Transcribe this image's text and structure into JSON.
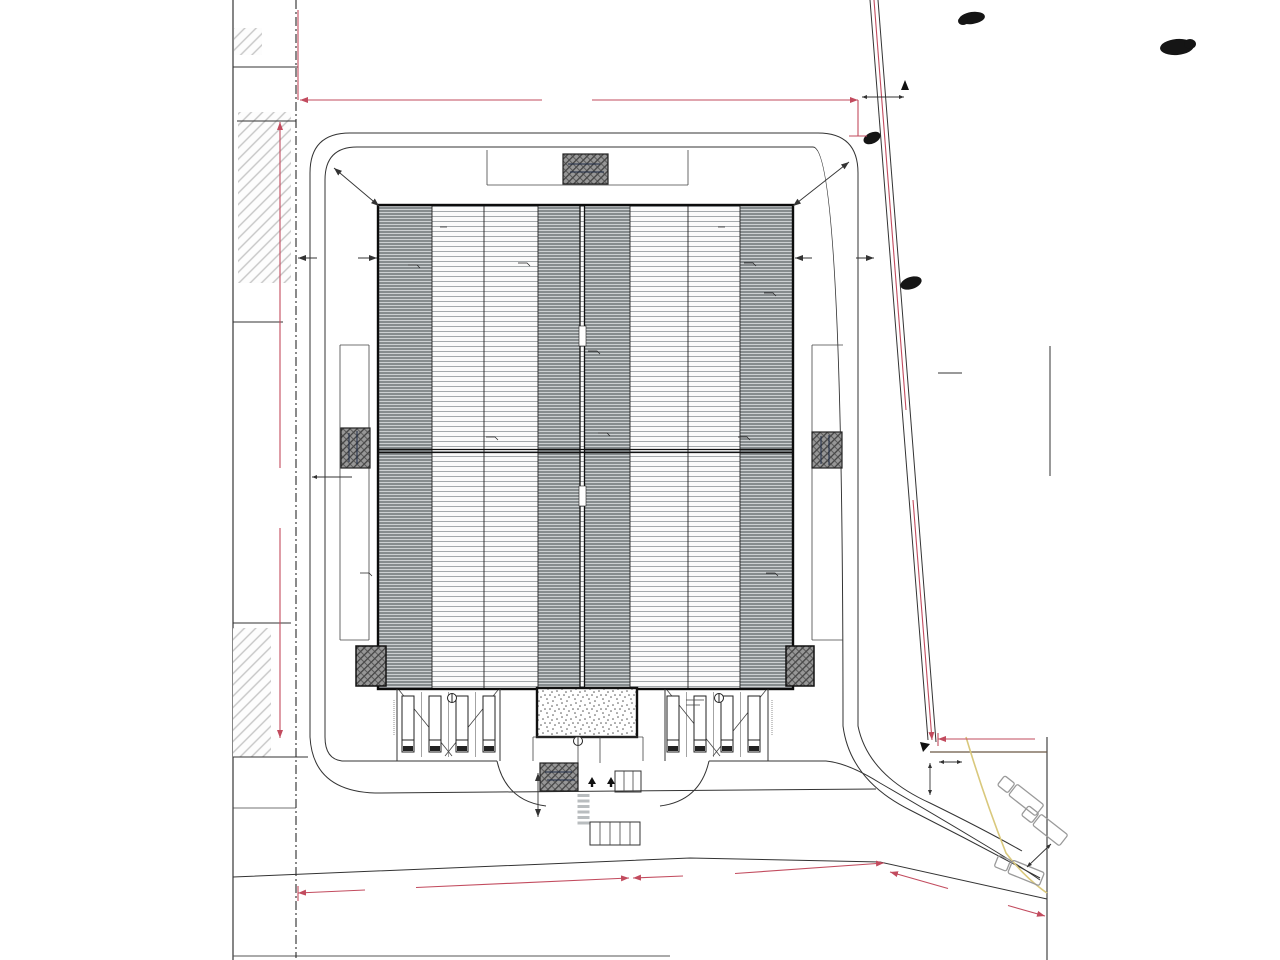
{
  "labels": {
    "parcel_top_line1": "parcelle 443 /",
    "parcel_top_line2": "6100m² - MAIRIE",
    "parcel_right_line1": "parcelles 44",
    "parcel_right_line2": "446 - 447 -",
    "parcel_right_line3": "441 - 442 /",
    "parcel_right_line4": "43 712m²",
    "voie_engins_top": "voie engins - 320KN",
    "voie_engins_left": "voie engins - 320KN",
    "voie_engins_right": "voie engins - 320KN",
    "bureaux": "Bureaux"
  },
  "dimensions": {
    "top_width": "140.78",
    "left_height": "187.03",
    "right_boundary": "157.29",
    "bottom_left": "47.97",
    "bottom_middle": "111.61",
    "bottom_right": "27.58",
    "road_top_width": "21.00",
    "corner_left": "13.00",
    "corner_right": "19.00",
    "setback_left": "21.10",
    "setback_right": "21.52",
    "strip_left": "6.02",
    "entrance": "7.00",
    "exit_gap": "6.00",
    "top_right": "11.00",
    "small_right": "12.02",
    "truck_lane": "4.00",
    "right_partial": "6"
  },
  "boundary_marks": {
    "left_1": "28.86",
    "left_2": "49.93",
    "left_3": "37.81",
    "left_4": "22.93",
    "left_5": "27.85",
    "right_1": "34.86",
    "right_2": "37.06"
  },
  "building": {
    "skylight_cols": [
      447,
      516,
      655,
      725
    ],
    "skylight_rows": [
      225,
      252,
      305,
      352,
      408,
      435,
      462,
      489,
      542,
      592,
      648,
      675
    ]
  },
  "trees": [
    [
      307,
      13,
      9
    ],
    [
      297,
      100,
      10
    ],
    [
      298,
      227,
      9
    ],
    [
      303,
      350,
      11
    ],
    [
      302,
      457,
      9
    ],
    [
      297,
      533,
      9
    ],
    [
      298,
      564,
      9
    ],
    [
      294,
      643,
      8
    ],
    [
      304,
      743,
      9
    ],
    [
      309,
      794,
      12
    ],
    [
      297,
      852,
      9
    ],
    [
      312,
      872,
      13
    ],
    [
      296,
      944,
      10
    ],
    [
      383,
      911,
      11
    ],
    [
      417,
      917,
      12
    ],
    [
      483,
      897,
      12
    ],
    [
      500,
      914,
      12
    ],
    [
      519,
      906,
      11
    ],
    [
      541,
      939,
      12
    ],
    [
      561,
      951,
      11
    ]
  ],
  "survey_marks": [
    [
      291,
      25
    ],
    [
      342,
      20
    ],
    [
      908,
      27
    ],
    [
      915,
      106
    ],
    [
      917,
      129
    ],
    [
      864,
      262
    ]
  ],
  "colors": {
    "dimension_red": "#c24b5e",
    "tree_green": "#57b42c",
    "tree_edge": "#2c7312",
    "survey_cyan": "#2ab3c4",
    "utility_yellow": "#d9c87c"
  }
}
